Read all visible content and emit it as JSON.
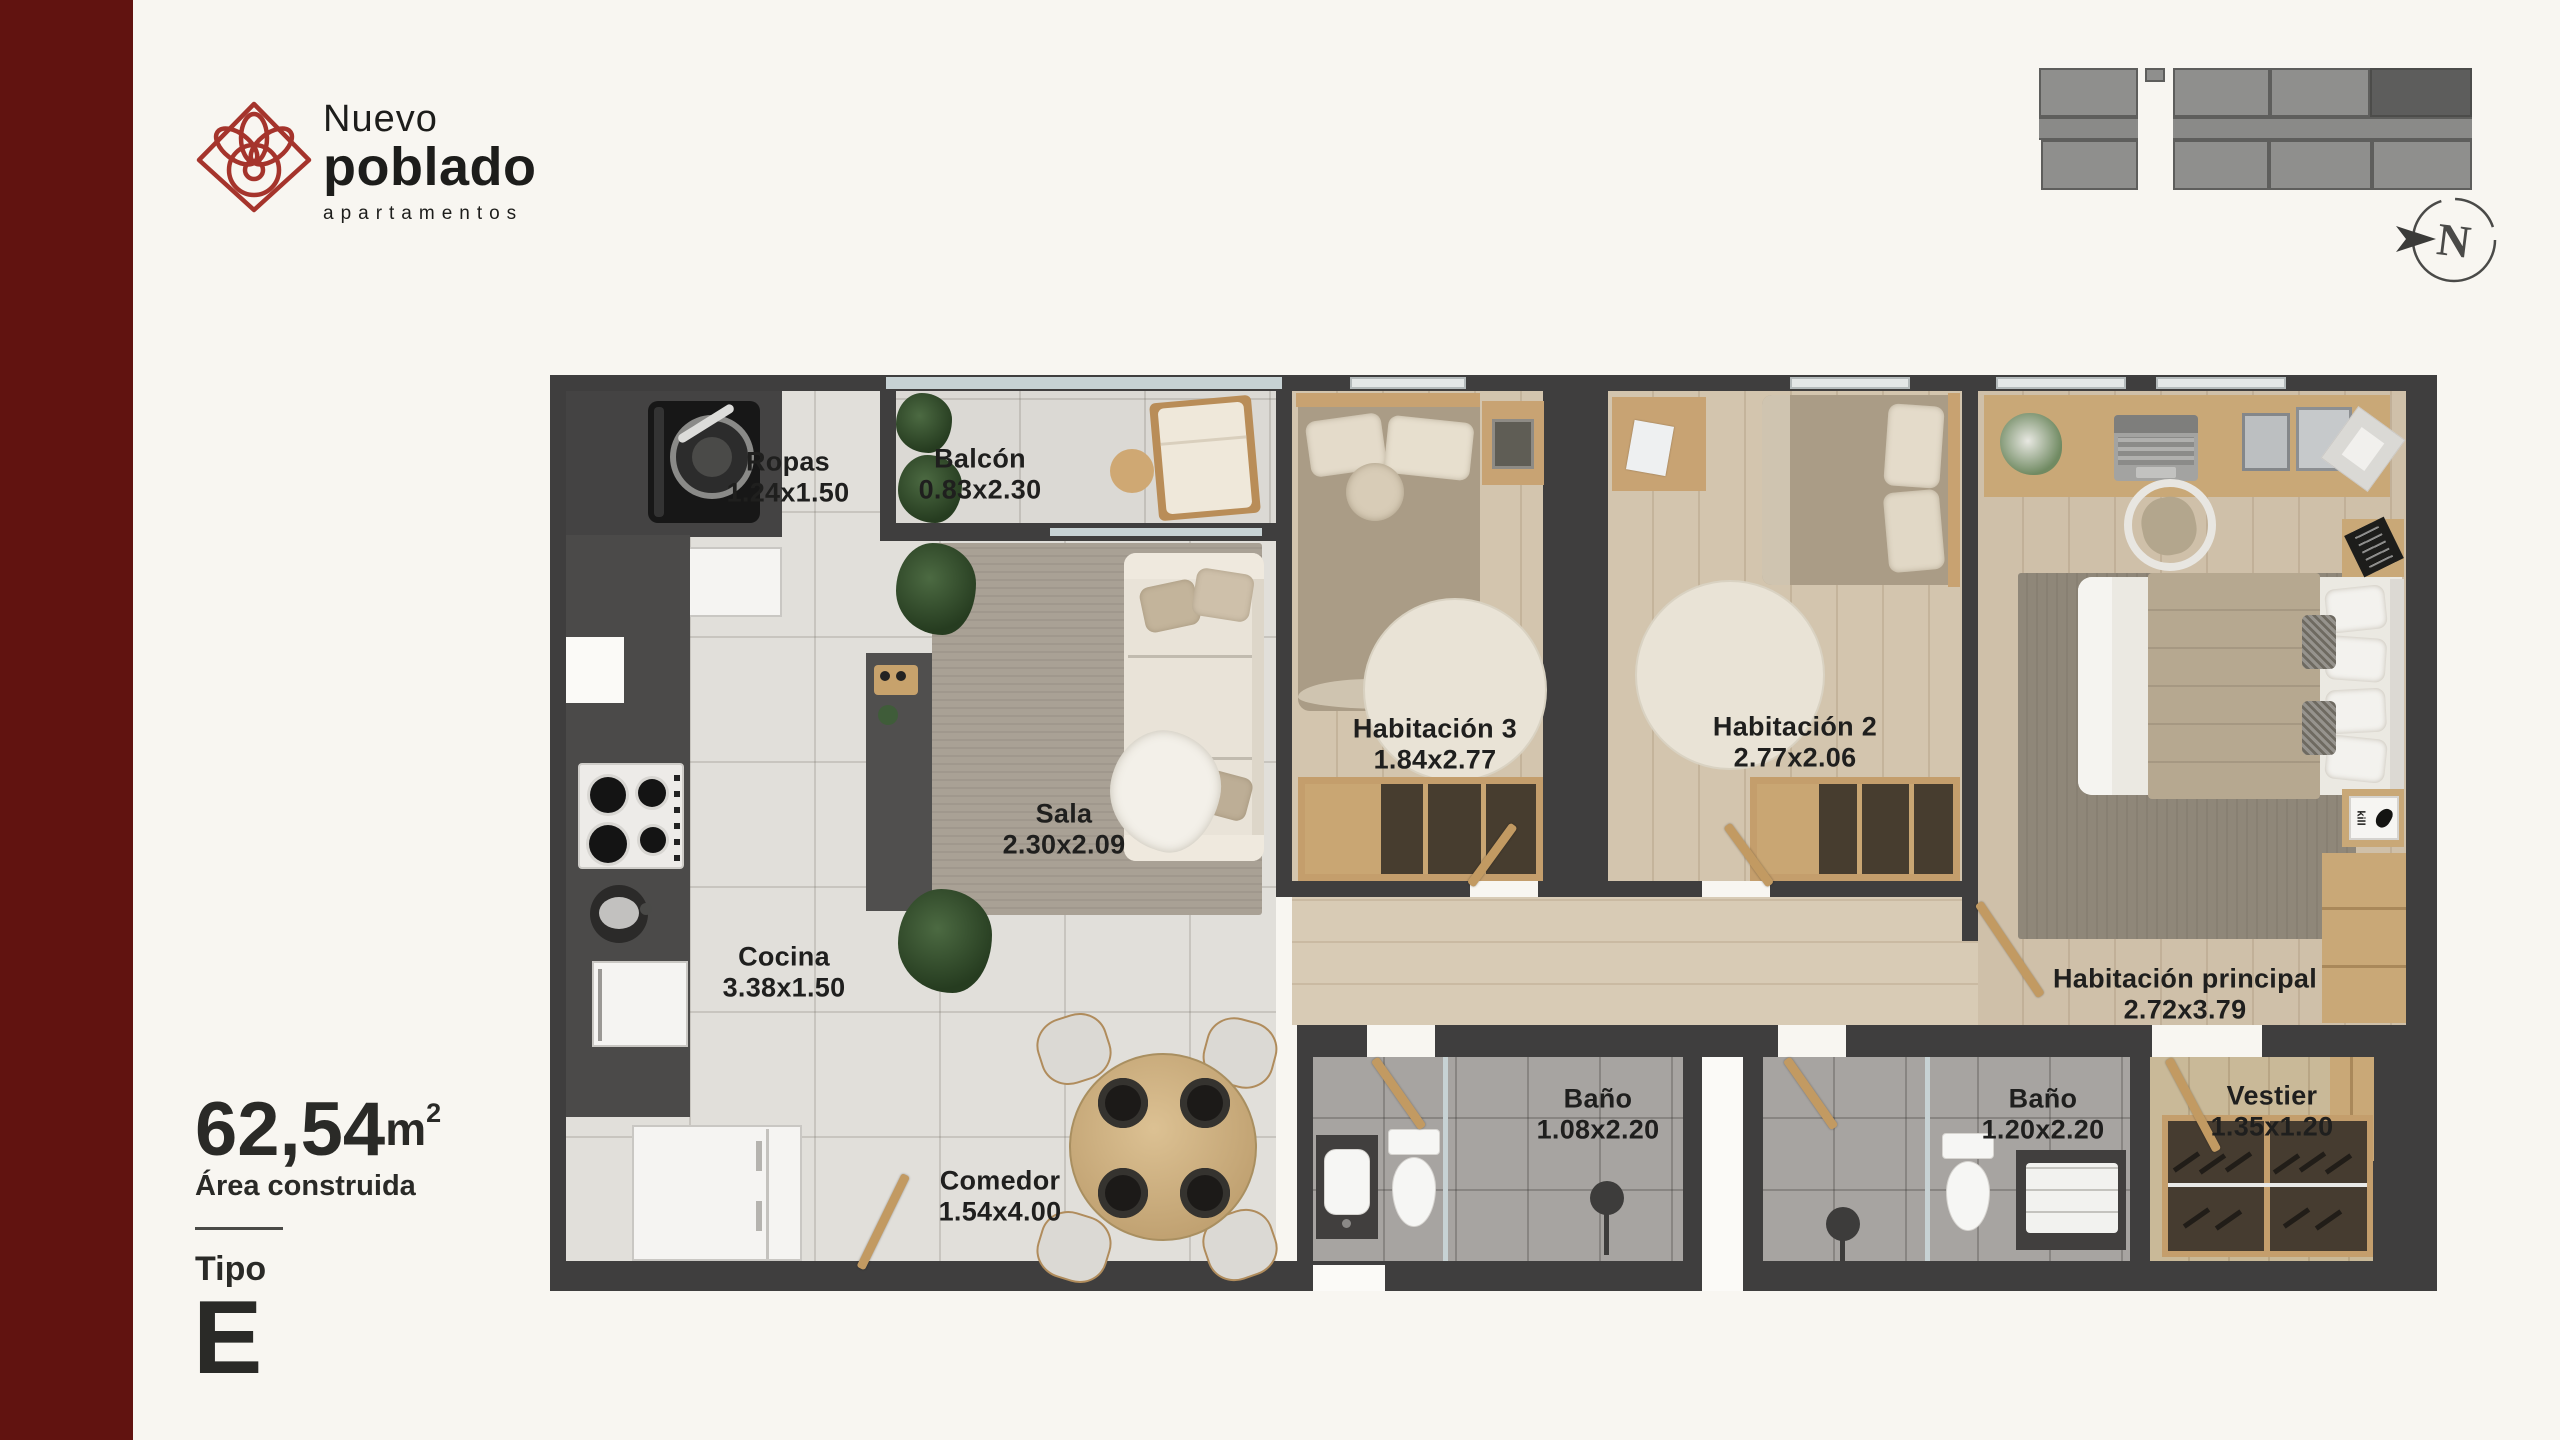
{
  "brand": {
    "name_line1": "Nuevo",
    "name_line2": "poblado",
    "tagline": "apartamentos"
  },
  "stats": {
    "area_value": "62,54",
    "area_unit": "m",
    "area_sup": "2",
    "area_label": "Área construida",
    "type_label": "Tipo",
    "type_value": "E"
  },
  "compass": {
    "letter": "N"
  },
  "rooms": [
    {
      "id": "ropas",
      "name": "Ropas",
      "dims": "1.24x1.50"
    },
    {
      "id": "balcon",
      "name": "Balcón",
      "dims": "0.83x2.30"
    },
    {
      "id": "sala",
      "name": "Sala",
      "dims": "2.30x2.09"
    },
    {
      "id": "cocina",
      "name": "Cocina",
      "dims": "3.38x1.50"
    },
    {
      "id": "comedor",
      "name": "Comedor",
      "dims": "1.54x4.00"
    },
    {
      "id": "habitacion-3",
      "name": "Habitación 3",
      "dims": "1.84x2.77"
    },
    {
      "id": "habitacion-2",
      "name": "Habitación 2",
      "dims": "2.77x2.06"
    },
    {
      "id": "habitacion-principal",
      "name": "Habitación principal",
      "dims": "2.72x3.79"
    },
    {
      "id": "bano-1",
      "name": "Baño",
      "dims": "1.08x2.20"
    },
    {
      "id": "bano-2",
      "name": "Baño",
      "dims": "1.20x2.20"
    },
    {
      "id": "vestier",
      "name": "Vestier",
      "dims": "1.35x1.20"
    }
  ],
  "plan": {
    "art_caption": "kill"
  },
  "colors": {
    "brand_red": "#a5342c",
    "sidebar_maroon": "#611310",
    "background": "#f8f6f1",
    "wall": "#3f3e3e",
    "text_dark": "#1f1f1e",
    "wood": "#c9a171",
    "keyplan_gray": "#8f8f8d",
    "keyplan_highlight": "#5d5d5c"
  }
}
